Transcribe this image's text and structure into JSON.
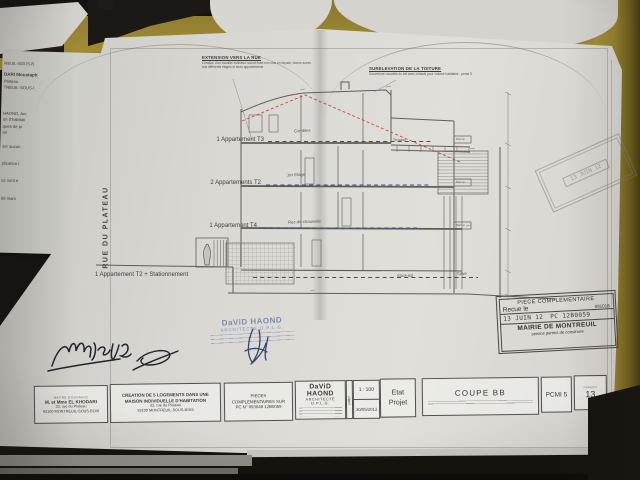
{
  "drawing": {
    "street_label": "RUE DU PLATEAU",
    "floor_labels": [
      "1 Appartement T3",
      "2 Appartements T2",
      "1 Appartement T4",
      "1 Appartement T2 + Stationnement"
    ],
    "rooms": {
      "combles": "Combles",
      "etage": "1er Etage",
      "rdc": "Rez-de-chaussée",
      "soussol": "Sous-sol",
      "cave": "Cave",
      "terrasse": "Terrasse",
      "balcon": "Balcon"
    },
    "annotations": {
      "extension_title": "EXTENSION VERS LA RUE",
      "extension_body": "Création d'un escalier extérieur nouvel tube non clos en façade, donne accès aux différents étages et leurs appartements",
      "surelevation_title": "SURELEVATION DE LA TOITURE",
      "surelevation_body": "Couverture nouvelle du toit avec châssis pour volume habitable - pente 5"
    }
  },
  "stamps": {
    "mairie": {
      "header": "PIECE COMPLEMENTAIRE",
      "received_label": "Recue le",
      "received_code": "091018",
      "date": "13 JUIN 12",
      "pc_number": "PC 12B0059",
      "authority": "MAIRIE DE MONTREUIL",
      "service": "service permis de construire"
    },
    "faint_date": "13 JUIN 12",
    "architect_name": "DaViD HAOND",
    "architect_title": "ARCHITECTE D.P.L.G."
  },
  "title_block": {
    "owner_header": "MAITRE D'OUVRAGE",
    "owner_name": "M. et Mme EL KHODARI",
    "owner_address1": "33, rue du Plateau",
    "owner_address2": "93100 MONTREUIL-SOUS-BOIS",
    "project_line1": "CREATION DE 5 LOGEMENTS DANS UNE",
    "project_line2": "MAISON INDIVIDUELLE D'HABITATION",
    "project_address1": "33, rue du Plateau",
    "project_address2": "93100 MONTREUIL-SOUS-BOIS",
    "pieces_line1": "PIECES",
    "pieces_line2": "COMPLEMENTAIRES SUR",
    "pieces_line3": "PC N° 093048 12B0059",
    "architect_name": "DaViD HAOND",
    "architect_title": "ARCHITECTE D.P.L.G.",
    "scale_label": "ECH.",
    "scale_value": "1 : 100",
    "date_label": "DATE",
    "date_value": "30/05/2012",
    "status_line1": "Etat",
    "status_line2": "Projet",
    "sheet_title": "COUPE BB",
    "code": "PCMI 5",
    "number_label": "NUMERO",
    "number_value": "13"
  },
  "underlying_page": {
    "fragments": [
      "REUIL-SOUS-B",
      "DARI Moustaph",
      "Plateau",
      "TREUIL-SOUS-I",
      "HAOND, Arc",
      "on d'habitati",
      "ques de pr",
      "ial",
      "ser aucun",
      "plication i",
      "es sont e",
      "09 mars"
    ]
  },
  "colors": {
    "paper": "#d9d8d3",
    "desk_olive": "#a08c34",
    "ink": "#5f5e5a",
    "blue_dash": "#3a4f8a",
    "red_dash": "#b23a32",
    "stamp_blue": "#3a4c8a"
  }
}
